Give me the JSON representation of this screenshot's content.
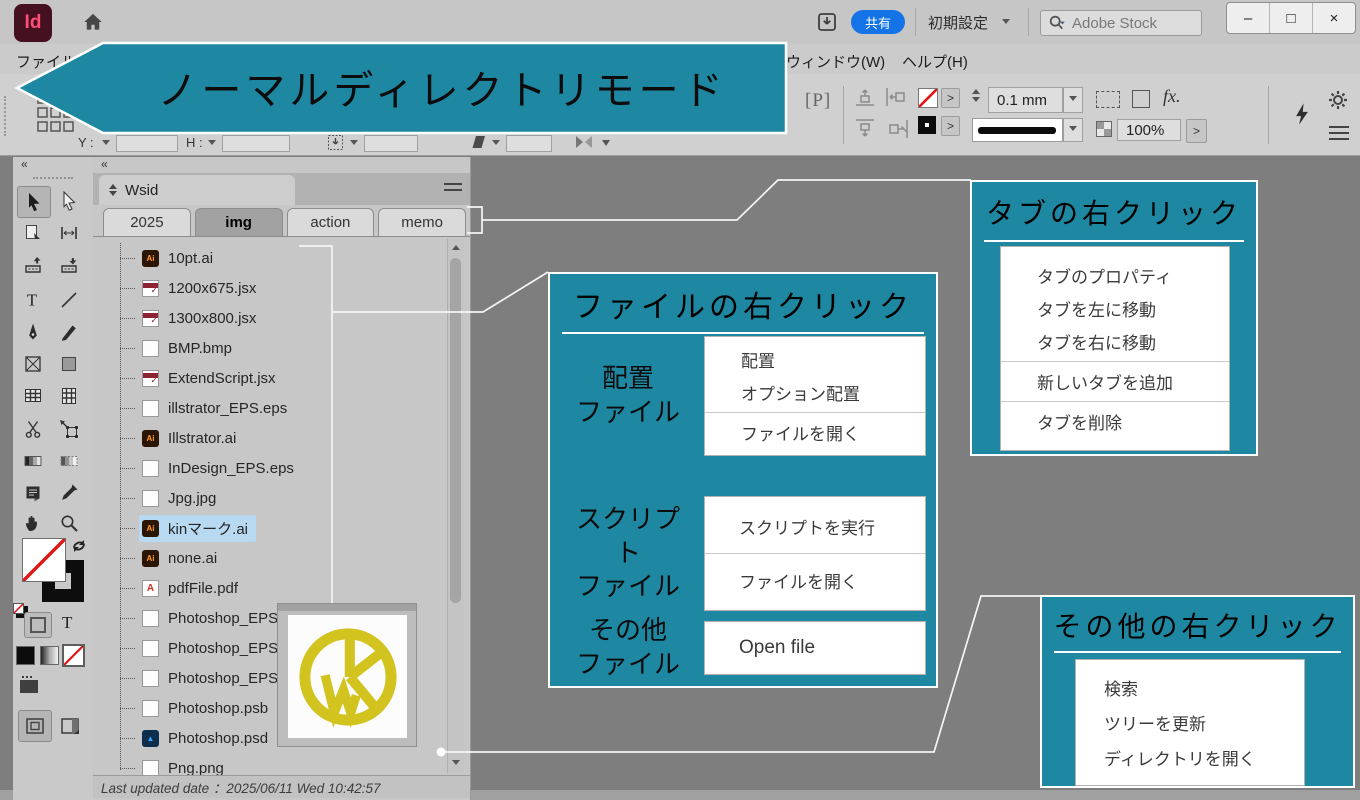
{
  "colors": {
    "accent_teal": "#1e87a1",
    "selection_blue": "#b7d9f2",
    "share_blue": "#1473e6",
    "logo_pink": "#ff4e78",
    "logo_bg": "#45101f"
  },
  "chrome": {
    "app_icon_text": "Id",
    "share_label": "共有",
    "workspace_label": "初期設定",
    "search_placeholder": "Adobe Stock",
    "window_buttons": {
      "minimize": "–",
      "maximize": "□",
      "close": "×"
    },
    "menu_left": "ファイル",
    "menu_right": [
      "ウィンドウ(W)",
      "ヘルプ(H)"
    ],
    "control_bar": {
      "y_label": "Y :",
      "h_label": "H :",
      "p_label": "[P]",
      "stroke_weight": "0.1 mm",
      "fx_label": "fx.",
      "opacity_value": "100%",
      "arrow_button": ">"
    }
  },
  "banner": {
    "label": "ノーマルディレクトリモード"
  },
  "panel": {
    "collapse_glyph": "«",
    "title": "Wsid",
    "tabs": [
      {
        "label": "2025",
        "active": false
      },
      {
        "label": "img",
        "active": true
      },
      {
        "label": "action",
        "active": false
      },
      {
        "label": "memo",
        "active": false
      }
    ],
    "files": [
      {
        "name": "10pt.ai",
        "icon": "ai"
      },
      {
        "name": "1200x675.jsx",
        "icon": "jsx"
      },
      {
        "name": "1300x800.jsx",
        "icon": "jsx"
      },
      {
        "name": "BMP.bmp",
        "icon": "doc"
      },
      {
        "name": "ExtendScript.jsx",
        "icon": "jsx"
      },
      {
        "name": "illstrator_EPS.eps",
        "icon": "doc"
      },
      {
        "name": "Illstrator.ai",
        "icon": "ai"
      },
      {
        "name": "InDesign_EPS.eps",
        "icon": "doc"
      },
      {
        "name": "Jpg.jpg",
        "icon": "doc"
      },
      {
        "name": "kinマーク.ai",
        "icon": "ai",
        "selected": true
      },
      {
        "name": "none.ai",
        "icon": "ai"
      },
      {
        "name": "pdfFile.pdf",
        "icon": "pdf"
      },
      {
        "name": "Photoshop_EPS_1bit",
        "icon": "doc"
      },
      {
        "name": "Photoshop_EPS_no",
        "icon": "doc"
      },
      {
        "name": "Photoshop_EPS.e",
        "icon": "doc"
      },
      {
        "name": "Photoshop.psb",
        "icon": "doc"
      },
      {
        "name": "Photoshop.psd",
        "icon": "psd"
      },
      {
        "name": "Png.png",
        "icon": "doc"
      }
    ],
    "status": "Last updated date ：2025/06/11 Wed 10:42:57"
  },
  "callouts": {
    "file": {
      "title": "ファイルの右クリック",
      "sections": [
        {
          "label_lines": [
            "配置",
            "ファイル"
          ],
          "groups": [
            [
              "配置",
              "オプション配置"
            ],
            [
              "ファイルを開く"
            ]
          ]
        },
        {
          "label_lines": [
            "スクリプト",
            "ファイル"
          ],
          "groups": [
            [
              "スクリプトを実行"
            ],
            [
              "ファイルを開く"
            ]
          ]
        },
        {
          "label_lines": [
            "その他",
            "ファイル"
          ],
          "groups": [
            [
              "Open file"
            ]
          ]
        }
      ]
    },
    "tab": {
      "title": "タブの右クリック",
      "groups": [
        [
          "タブのプロパティ",
          "タブを左に移動",
          "タブを右に移動"
        ],
        [
          "新しいタブを追加"
        ],
        [
          "タブを削除"
        ]
      ]
    },
    "other": {
      "title": "その他の右クリック",
      "groups": [
        [
          "検索",
          "ツリーを更新",
          "ディレクトリを開く"
        ]
      ]
    }
  }
}
